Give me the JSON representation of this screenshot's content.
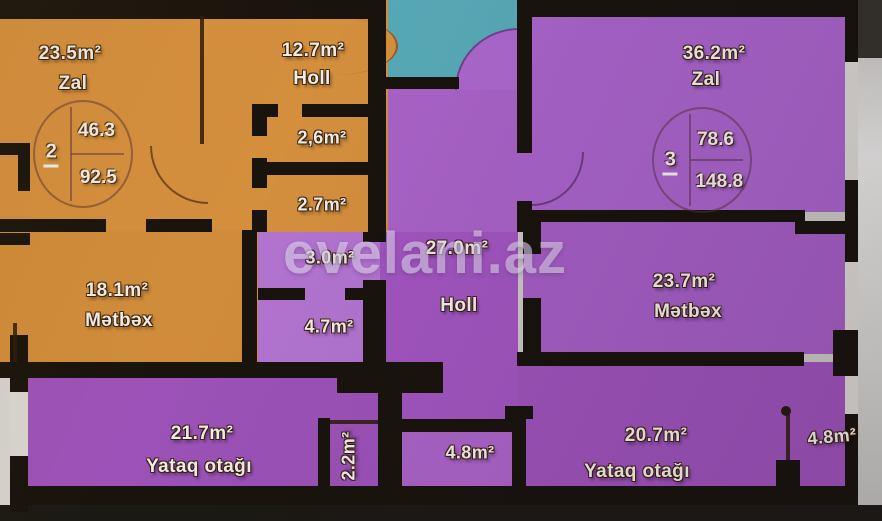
{
  "watermark": "evelani.az",
  "apartments": {
    "left": {
      "number": "2",
      "living_area": "46.3",
      "total_area": "92.5",
      "zal": {
        "area": "23.5m²",
        "name": "Zal"
      },
      "holl": {
        "area": "12.7m²",
        "name": "Holl"
      },
      "bath": {
        "area": "2,6m²"
      },
      "wc": {
        "area": "2.7m²"
      },
      "metbex": {
        "area": "18.1m²",
        "name": "Mətbəx"
      }
    },
    "right": {
      "number": "3",
      "living_area": "78.6",
      "total_area": "148.8",
      "zal": {
        "area": "36.2m²",
        "name": "Zal"
      },
      "holl": {
        "area": "27.0m²",
        "name": "Holl"
      },
      "metbex": {
        "area": "23.7m²",
        "name": "Mətbəx"
      },
      "storage": {
        "area": "3.0m²"
      },
      "bath": {
        "area": "4.7m²"
      },
      "bedroom_left": {
        "area": "21.7m²",
        "name": "Yataq otağı"
      },
      "closet": {
        "area": "2.2m²"
      },
      "balcony_center": {
        "area": "4.8m²"
      },
      "bedroom_right": {
        "area": "20.7m²",
        "name": "Yataq otağı"
      },
      "balcony_right": {
        "area": "4.8m²"
      }
    }
  },
  "colors": {
    "unit_left_orange": "#d48f3d",
    "unit_right_purple": "#a55cc2",
    "background_teal": "#57a9b7",
    "wall_black": "#18130c"
  }
}
